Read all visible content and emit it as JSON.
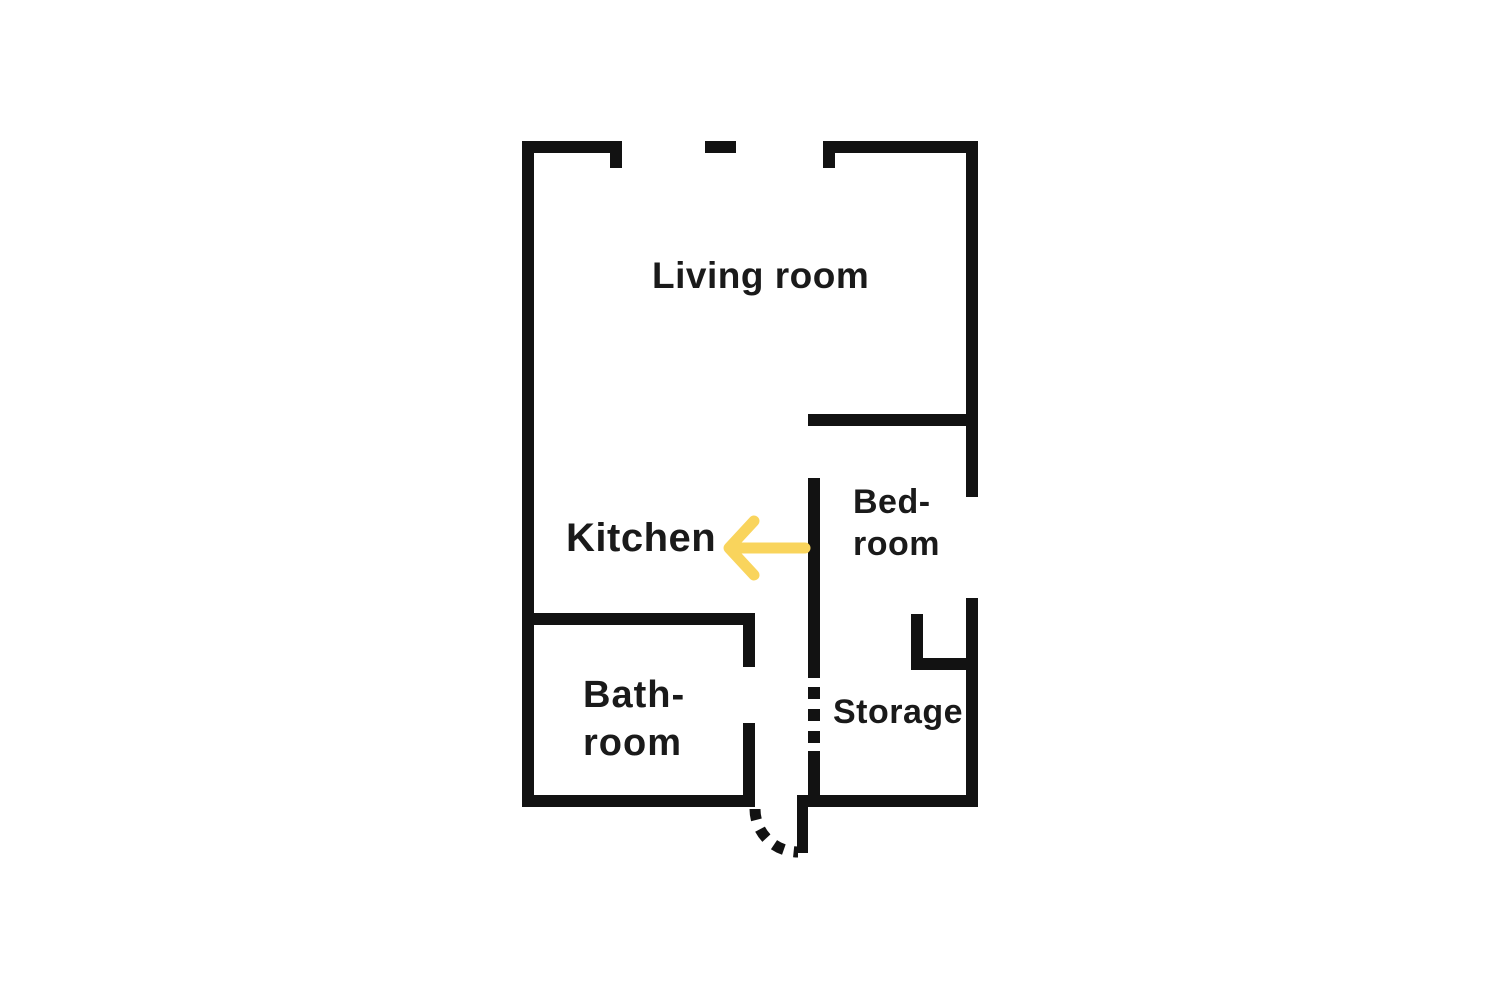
{
  "colors": {
    "background": "#ffffff",
    "wall": "#121212",
    "text": "#1a1a1a",
    "arrow": "#F9D45C"
  },
  "rooms": {
    "living_room": {
      "label": "Living room"
    },
    "kitchen": {
      "label": "Kitchen"
    },
    "bedroom": {
      "line1": "Bed-",
      "line2": "room"
    },
    "bathroom": {
      "line1": "Bath-",
      "line2": "room"
    },
    "storage": {
      "label": "Storage"
    }
  },
  "annotations": {
    "kitchen_arrow": {
      "icon": "arrow-left-icon",
      "direction": "left"
    }
  }
}
